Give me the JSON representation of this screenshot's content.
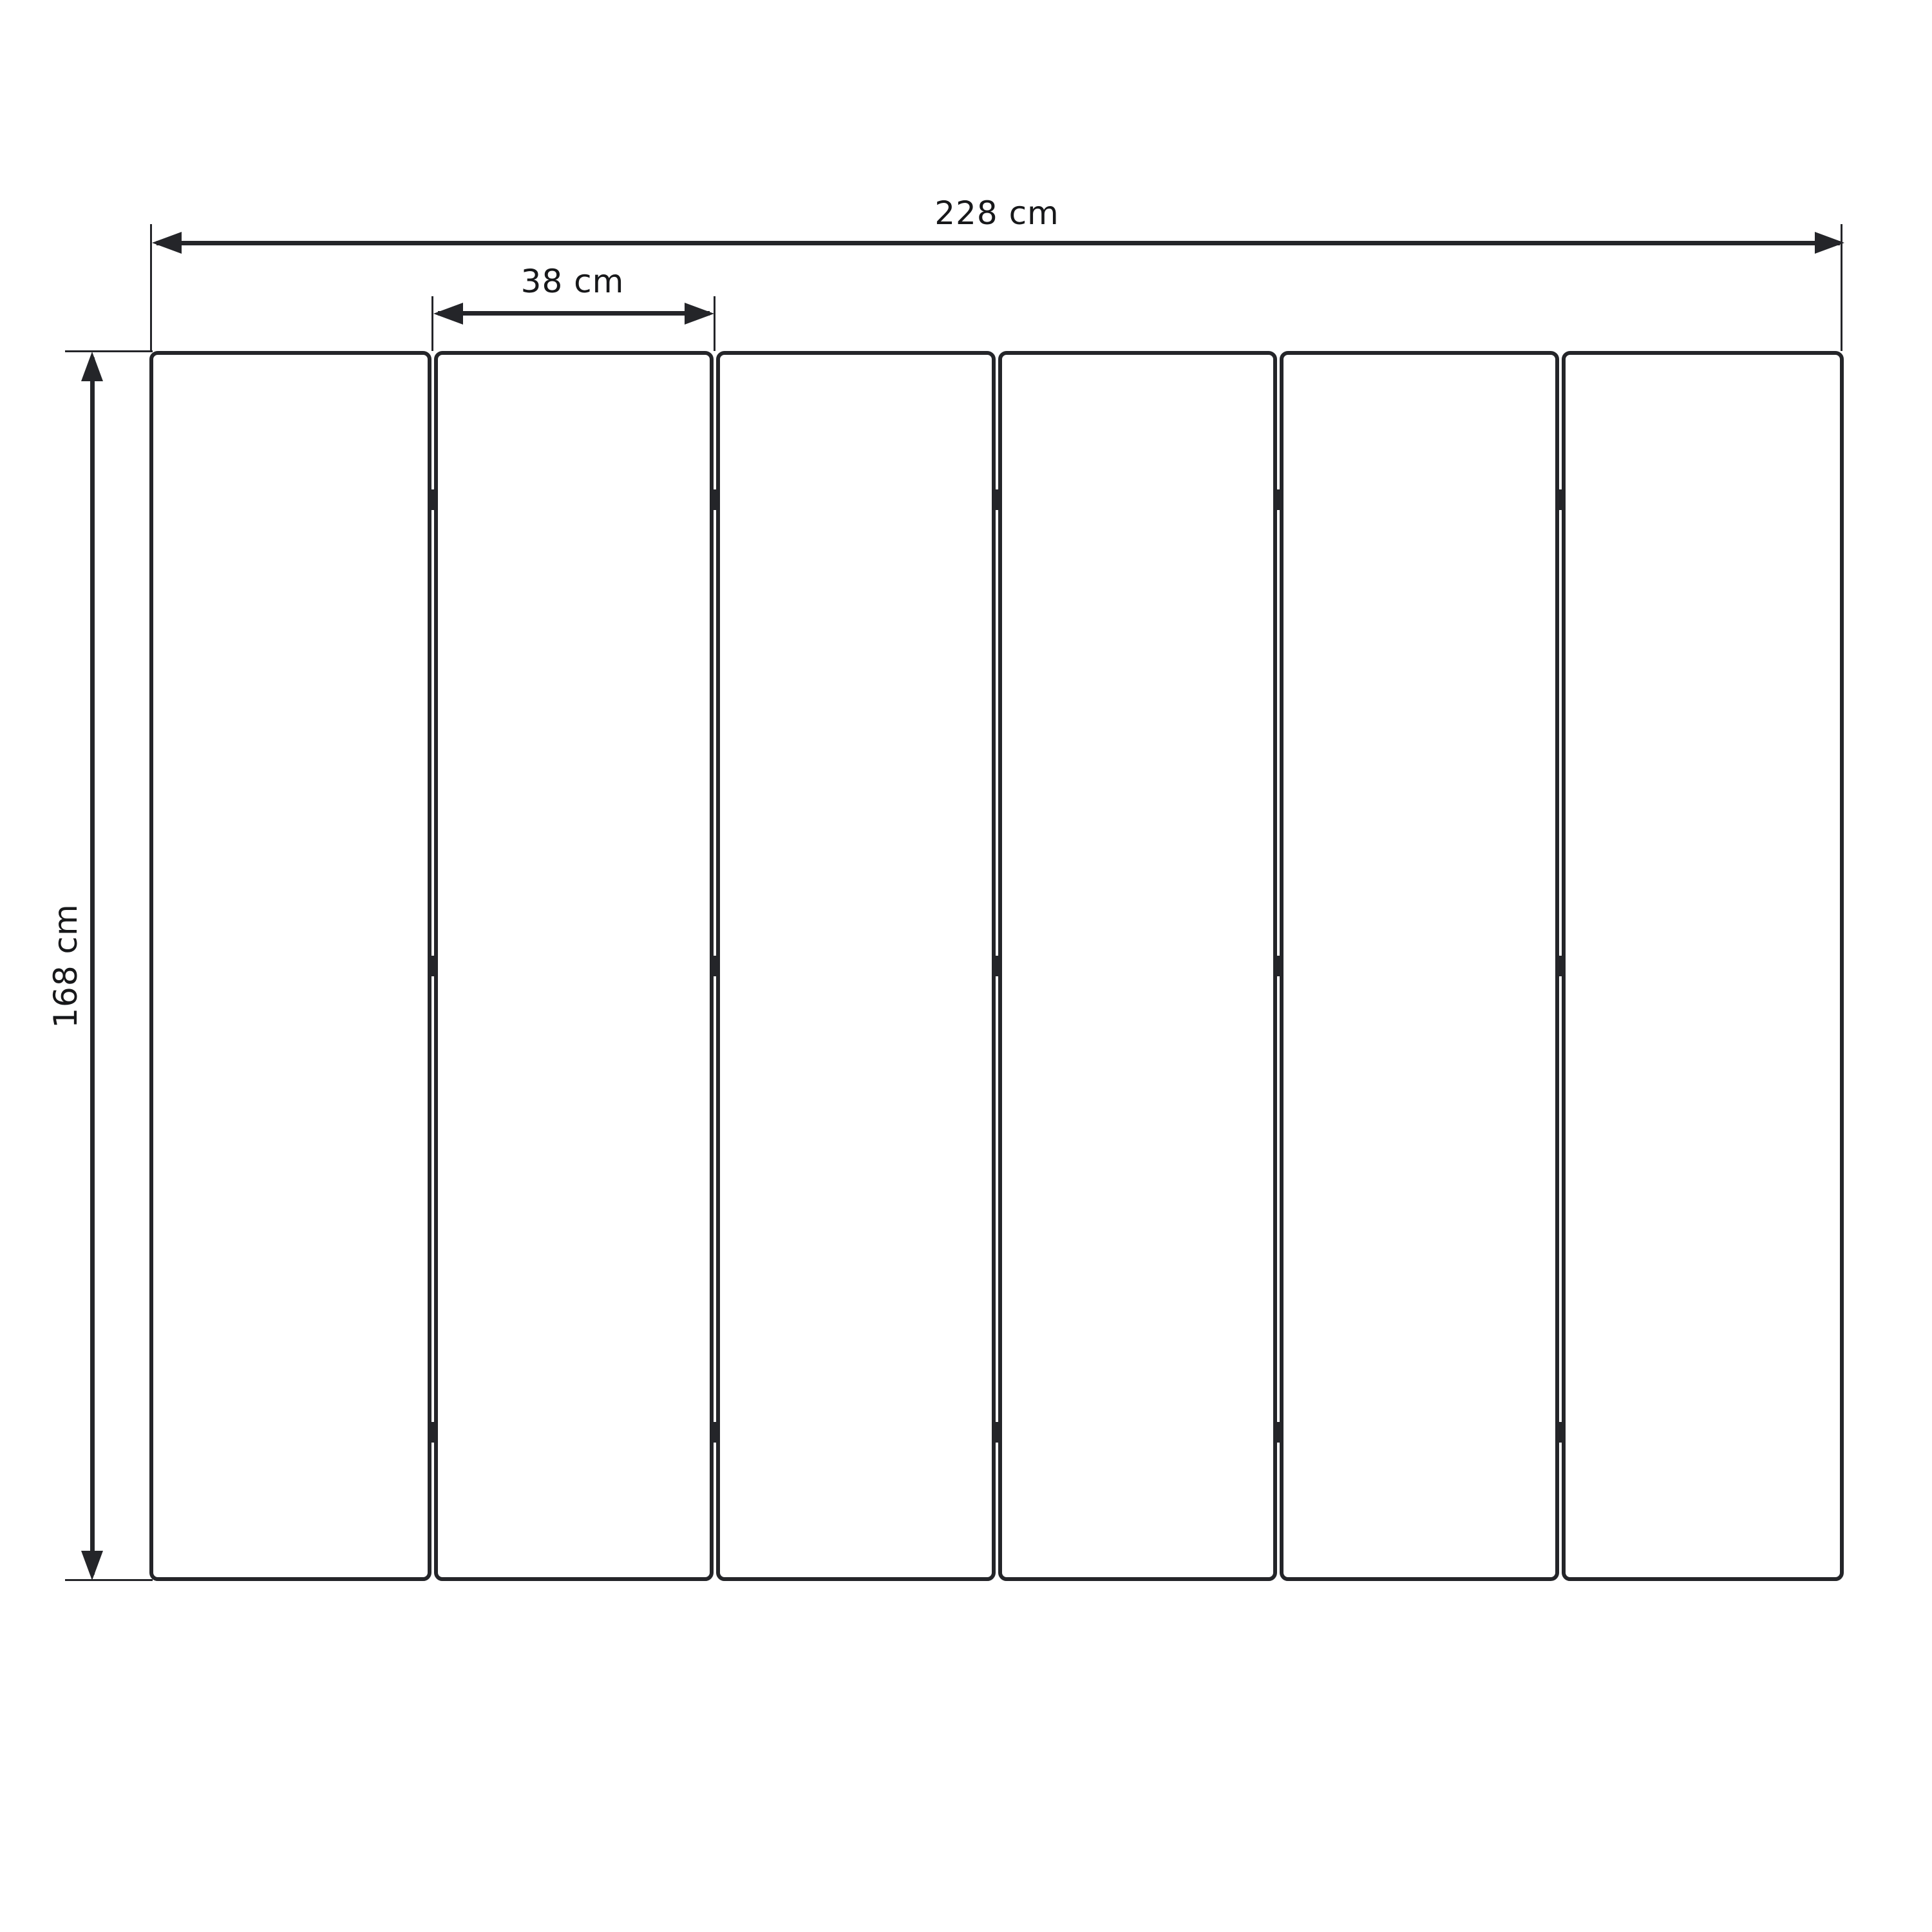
{
  "diagram": {
    "panel_count": 6,
    "hinge_columns": 5,
    "hinge_rows": 3,
    "labels": {
      "total_width": "228 cm",
      "panel_width": "38 cm",
      "height": "168 cm"
    },
    "colors": {
      "line": "#242529",
      "text": "#17181a",
      "background": "#ffffff"
    }
  }
}
